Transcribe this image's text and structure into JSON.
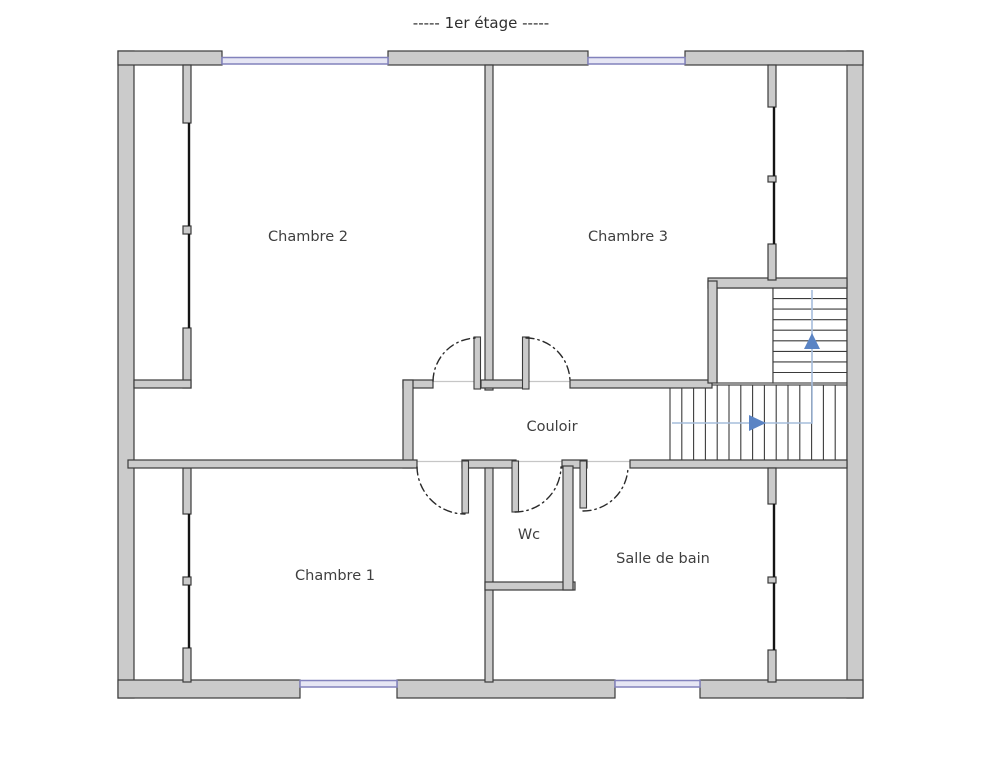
{
  "title": "-----  1er étage  -----",
  "rooms": [
    {
      "id": "chambre2",
      "label": "Chambre 2"
    },
    {
      "id": "chambre3",
      "label": "Chambre 3"
    },
    {
      "id": "couloir",
      "label": "Couloir"
    },
    {
      "id": "chambre1",
      "label": "Chambre 1"
    },
    {
      "id": "wc",
      "label": "Wc"
    },
    {
      "id": "salle_de_bain",
      "label": "Salle de bain"
    }
  ],
  "stairs": {
    "lower_flight_direction": "right",
    "upper_flight_direction": "up"
  },
  "colors": {
    "wall_fill": "#cbcbcb",
    "wall_stroke": "#3b3b3b",
    "window_fill": "#e6e6f4",
    "window_frame": "#8282bc",
    "walk_line": "#a6bddc",
    "stair_arrow": "#5b84c4",
    "label_text": "#3f3f3f"
  }
}
